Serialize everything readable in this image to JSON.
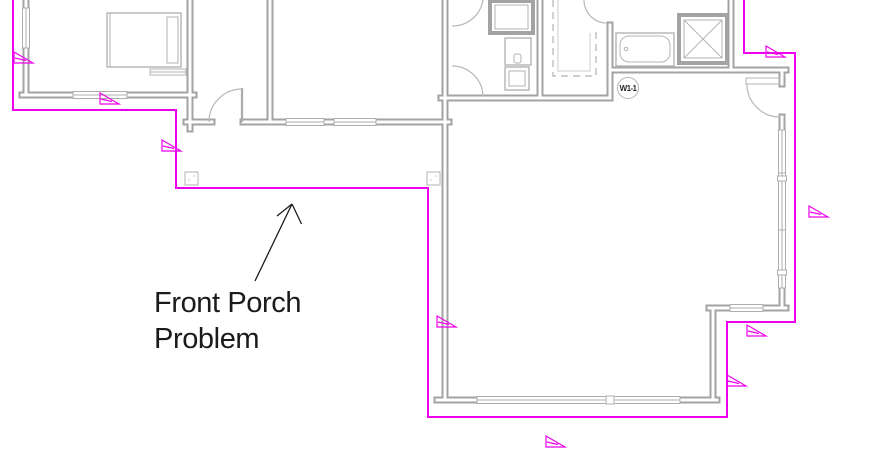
{
  "canvas": {
    "width": 869,
    "height": 473,
    "background": "#ffffff"
  },
  "annotation": {
    "line1": "Front Porch",
    "line2": "Problem"
  },
  "window_tag": {
    "label": "W1-1"
  },
  "colors": {
    "wall": "#a3a3a3",
    "fixture_line": "#b3b3b3",
    "window_line": "#aeaeae",
    "boundary_magenta": "#ee00ee",
    "annotation_text": "#1b1b1b",
    "tag_text": "#2a2a2a"
  },
  "boundary_points": "13,0 13,110 176,110 176,188 428,188 428,417 727,417 727,322 795,322 795,53 744,53 744,0",
  "flags": [
    {
      "x": 14,
      "y": 52
    },
    {
      "x": 100,
      "y": 93
    },
    {
      "x": 162,
      "y": 140
    },
    {
      "x": 766,
      "y": 46
    },
    {
      "x": 809,
      "y": 206
    },
    {
      "x": 437,
      "y": 316
    },
    {
      "x": 747,
      "y": 325
    },
    {
      "x": 727,
      "y": 375
    },
    {
      "x": 546,
      "y": 436
    }
  ]
}
